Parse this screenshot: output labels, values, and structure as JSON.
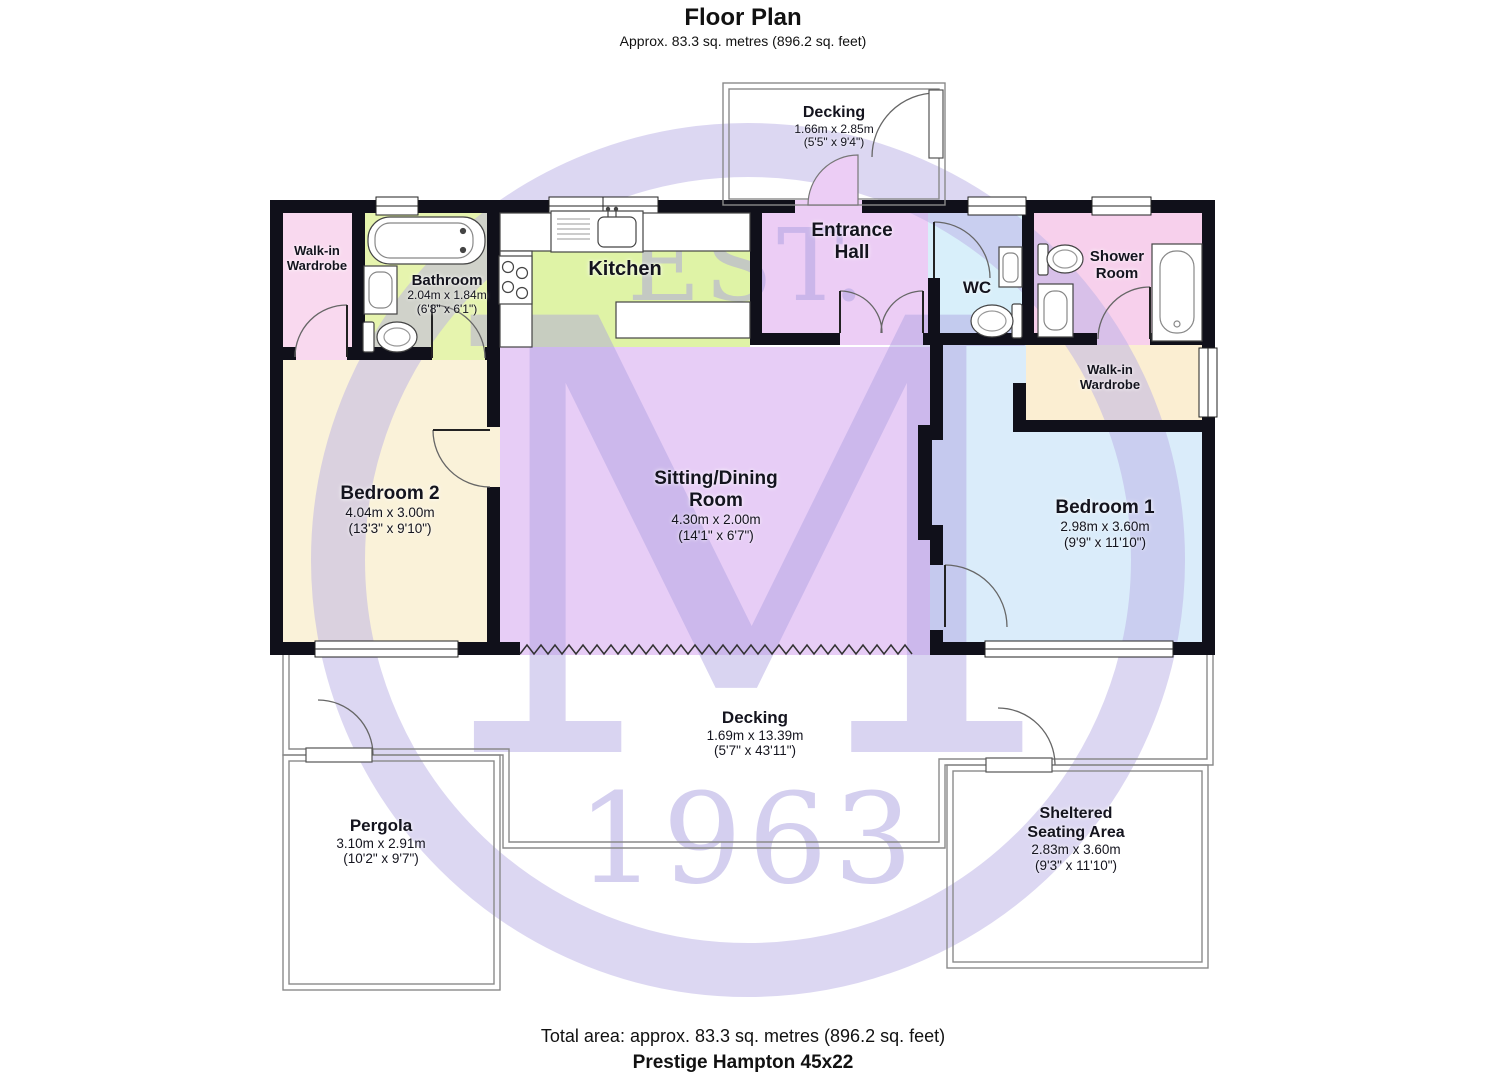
{
  "header": {
    "title": "Floor Plan",
    "subtitle": "Approx. 83.3 sq. metres (896.2 sq. feet)"
  },
  "watermark": {
    "est": "EST.",
    "monogram": "M",
    "year": "1963"
  },
  "rooms": {
    "decking_top": {
      "name": "Decking",
      "dims_m": "1.66m x 2.85m",
      "dims_ft": "(5'5\" x 9'4\")"
    },
    "walkin_wardrobe_left": {
      "name": "Walk-in Wardrobe"
    },
    "bathroom": {
      "name": "Bathroom",
      "dims_m": "2.04m x 1.84m",
      "dims_ft": "(6'8\" x 6'1\")"
    },
    "kitchen": {
      "name": "Kitchen"
    },
    "entrance_hall": {
      "name": "Entrance Hall"
    },
    "wc": {
      "name": "WC"
    },
    "shower_room": {
      "name": "Shower Room"
    },
    "walkin_wardrobe_right": {
      "name": "Walk-in Wardrobe"
    },
    "bedroom2": {
      "name": "Bedroom 2",
      "dims_m": "4.04m x 3.00m",
      "dims_ft": "(13'3\" x 9'10\")"
    },
    "sitting_dining": {
      "name": "Sitting/Dining Room",
      "dims_m": "4.30m x 2.00m",
      "dims_ft": "(14'1\" x 6'7\")"
    },
    "bedroom1": {
      "name": "Bedroom 1",
      "dims_m": "2.98m x 3.60m",
      "dims_ft": "(9'9\" x 11'10\")"
    },
    "decking_bottom": {
      "name": "Decking",
      "dims_m": "1.69m x 13.39m",
      "dims_ft": "(5'7\" x 43'11\")"
    },
    "pergola": {
      "name": "Pergola",
      "dims_m": "3.10m x 2.91m",
      "dims_ft": "(10'2\" x 9'7\")"
    },
    "sheltered_seating": {
      "name": "Sheltered Seating Area",
      "dims_m": "2.83m x 3.60m",
      "dims_ft": "(9'3\" x 11'10\")"
    }
  },
  "footer": {
    "total_area": "Total area: approx. 83.3 sq. metres (896.2 sq. feet)",
    "model": "Prestige Hampton 45x22"
  },
  "colors": {
    "wall": "#10101a",
    "wardrobe_pink": "#f9d9ef",
    "bathroom_green": "#e6f4ae",
    "kitchen_green": "#dff3a6",
    "hall_purple": "#eccdf5",
    "wc_blue": "#d8effa",
    "shower_pink": "#f7d0ec",
    "wardrobe_cream": "#fbeed2",
    "bedroom2_cream": "#faf2d9",
    "sitting_purple": "#e7cdf6",
    "bedroom1_blue": "#daecfa",
    "watermark": "#b9aede"
  }
}
